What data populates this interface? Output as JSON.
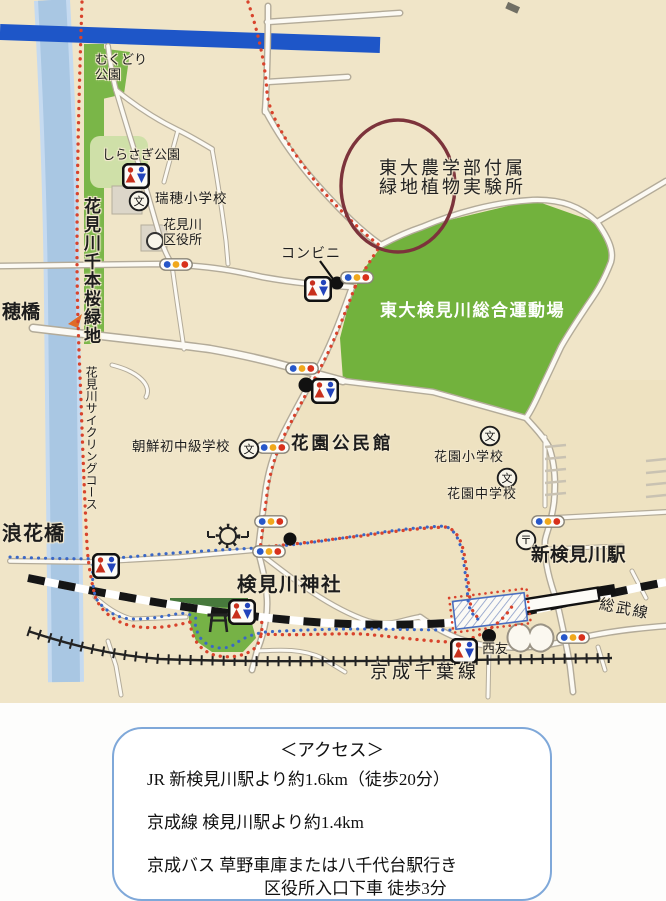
{
  "map": {
    "labels": {
      "mukudori_park": "むくどり公園",
      "shirasagi_park": "しらさぎ公園",
      "mizuho_elementary": "瑞穂小学校",
      "ward_office_line1": "花見川",
      "ward_office_line2": "区役所",
      "conbini": "コンビニ",
      "todai_lab_line1": "東大農学部付属",
      "todai_lab_line2": "緑地植物実験所",
      "sports_ground": "東大検見川総合運動場",
      "senbonzakura_greenbelt": "花見川千本桜緑地",
      "ho_bridge": "穂橋",
      "cycling_course": "花見川サイクリングコース",
      "korean_school": "朝鮮初中級学校",
      "hanazono_community_center": "花園公民館",
      "hanazono_elementary": "花園小学校",
      "hanazono_junior_high": "花園中学校",
      "naniwa_bridge": "浪花橋",
      "kemigawa_shrine": "検見川神社",
      "shin_kemigawa_station": "新検見川駅",
      "sobu_line": "総武線",
      "seiyu": "西友",
      "keisei_chiba_line": "京成千葉線"
    },
    "icons": {
      "school_glyph": "文",
      "post_office_glyph": "〒"
    },
    "colors": {
      "route_red": "#d8432c",
      "route_blue": "#3a67c6",
      "park_green": "#72b23d",
      "river_blue": "#a9c7e3",
      "highway_blue": "#1e56c8",
      "annotation_maroon": "#7c333b",
      "rail_black": "#151515"
    }
  },
  "access": {
    "title": "＜アクセス＞",
    "line1": "JR 新検見川駅より約1.6km（徒歩20分）",
    "line2": "京成線 検見川駅より約1.4km",
    "line3": "京成バス 草野車庫または八千代台駅行き",
    "line4": "区役所入口下車 徒歩3分"
  }
}
